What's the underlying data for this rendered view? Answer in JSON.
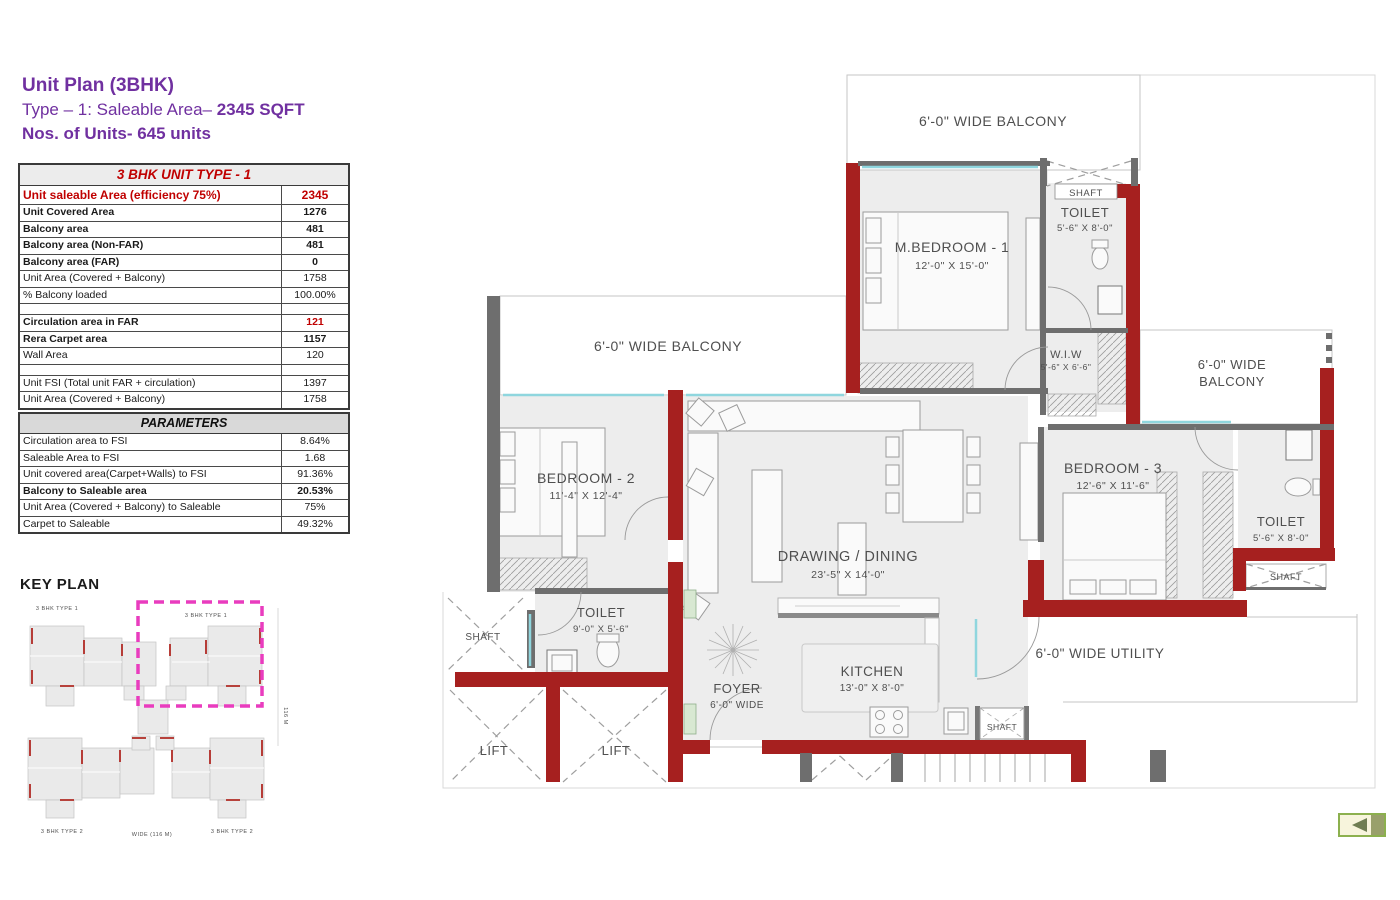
{
  "title_block": {
    "line1": "Unit Plan (3BHK)",
    "line2_prefix": "Type – 1: Saleable Area– ",
    "line2_bold": "2345 SQFT",
    "line3": "Nos. of Units- 645 units",
    "accent_color": "#7030A0"
  },
  "unit_table": {
    "title": "3 BHK UNIT TYPE - 1",
    "rows": [
      {
        "label": "Unit saleable Area (efficiency 75%)",
        "value": "2345"
      },
      {
        "label": "Unit Covered Area",
        "value": "1276"
      },
      {
        "label": "Balcony area",
        "value": "481"
      },
      {
        "label": "Balcony area (Non-FAR)",
        "value": "481"
      },
      {
        "label": "Balcony area (FAR)",
        "value": "0"
      },
      {
        "label": "Unit Area (Covered + Balcony)",
        "value": "1758"
      },
      {
        "label": "% Balcony loaded",
        "value": "100.00%"
      },
      {
        "label": "",
        "value": ""
      },
      {
        "label": "Circulation area in FAR",
        "value": "121"
      },
      {
        "label": "Rera Carpet area",
        "value": "1157"
      },
      {
        "label": "Wall Area",
        "value": "120"
      },
      {
        "label": "",
        "value": ""
      },
      {
        "label": "Unit FSI (Total unit FAR + circulation)",
        "value": "1397"
      },
      {
        "label": "Unit Area (Covered + Balcony)",
        "value": "1758"
      }
    ]
  },
  "parameters_table": {
    "title": "PARAMETERS",
    "rows": [
      {
        "label": "Circulation area to FSI",
        "value": "8.64%"
      },
      {
        "label": "Saleable Area to FSI",
        "value": "1.68"
      },
      {
        "label": "Unit covered area(Carpet+Walls) to FSI",
        "value": "91.36%"
      },
      {
        "label": "Balcony to Saleable area",
        "value": "20.53%"
      },
      {
        "label": "Unit Area (Covered + Balcony) to Saleable",
        "value": "75%"
      },
      {
        "label": "Carpet to Saleable",
        "value": "49.32%"
      }
    ]
  },
  "key_plan": {
    "title": "KEY PLAN",
    "label_top_left": "3 BHK TYPE 1",
    "label_top_right": "3 BHK TYPE 1",
    "label_bottom_left": "3 BHK TYPE 2",
    "label_bottom_right": "3 BHK TYPE 2",
    "dim_bottom": "WIDE (116 M)",
    "dim_right": "116 M",
    "highlight_color": "#E93CBE"
  },
  "floor_plan": {
    "colors": {
      "wall_red": "#A6201F",
      "wall_gray": "#6E6E6E",
      "floor": "#EDEDED",
      "window": "#8FD6DE"
    },
    "balcony_top": "6'-0\" WIDE BALCONY",
    "balcony_left": "6'-0\" WIDE BALCONY",
    "balcony_right_line1": "6'-0\" WIDE",
    "balcony_right_line2": "BALCONY",
    "utility": "6'-0\" WIDE UTILITY",
    "rooms": {
      "m_bedroom": {
        "name": "M.BEDROOM - 1",
        "dims": "12'-0\" X 15'-0\""
      },
      "bedroom2": {
        "name": "BEDROOM - 2",
        "dims": "11'-4\" X 12'-4\""
      },
      "bedroom3": {
        "name": "BEDROOM - 3",
        "dims": "12'-6\" X 11'-6\""
      },
      "drawing_dining": {
        "name": "DRAWING / DINING",
        "dims": "23'-5\" X 14'-0\""
      },
      "kitchen": {
        "name": "KITCHEN",
        "dims": "13'-0\" X 8'-0\""
      },
      "foyer": {
        "name": "FOYER",
        "dims": "6'-0\" WIDE"
      },
      "toilet_top": {
        "name": "TOILET",
        "dims": "5'-6\" X 8'-0\""
      },
      "toilet_right": {
        "name": "TOILET",
        "dims": "5'-6\" X 8'-0\""
      },
      "toilet_bottom": {
        "name": "TOILET",
        "dims": "9'-0\" X 5'-6\""
      },
      "wiw": {
        "name": "W.I.W",
        "dims": "5'-6\" X 6'-6\""
      }
    },
    "labels": {
      "lift": "LIFT",
      "shaft": "SHAFT"
    }
  },
  "nav": {
    "back_arrow_icon": "left-triangle"
  }
}
